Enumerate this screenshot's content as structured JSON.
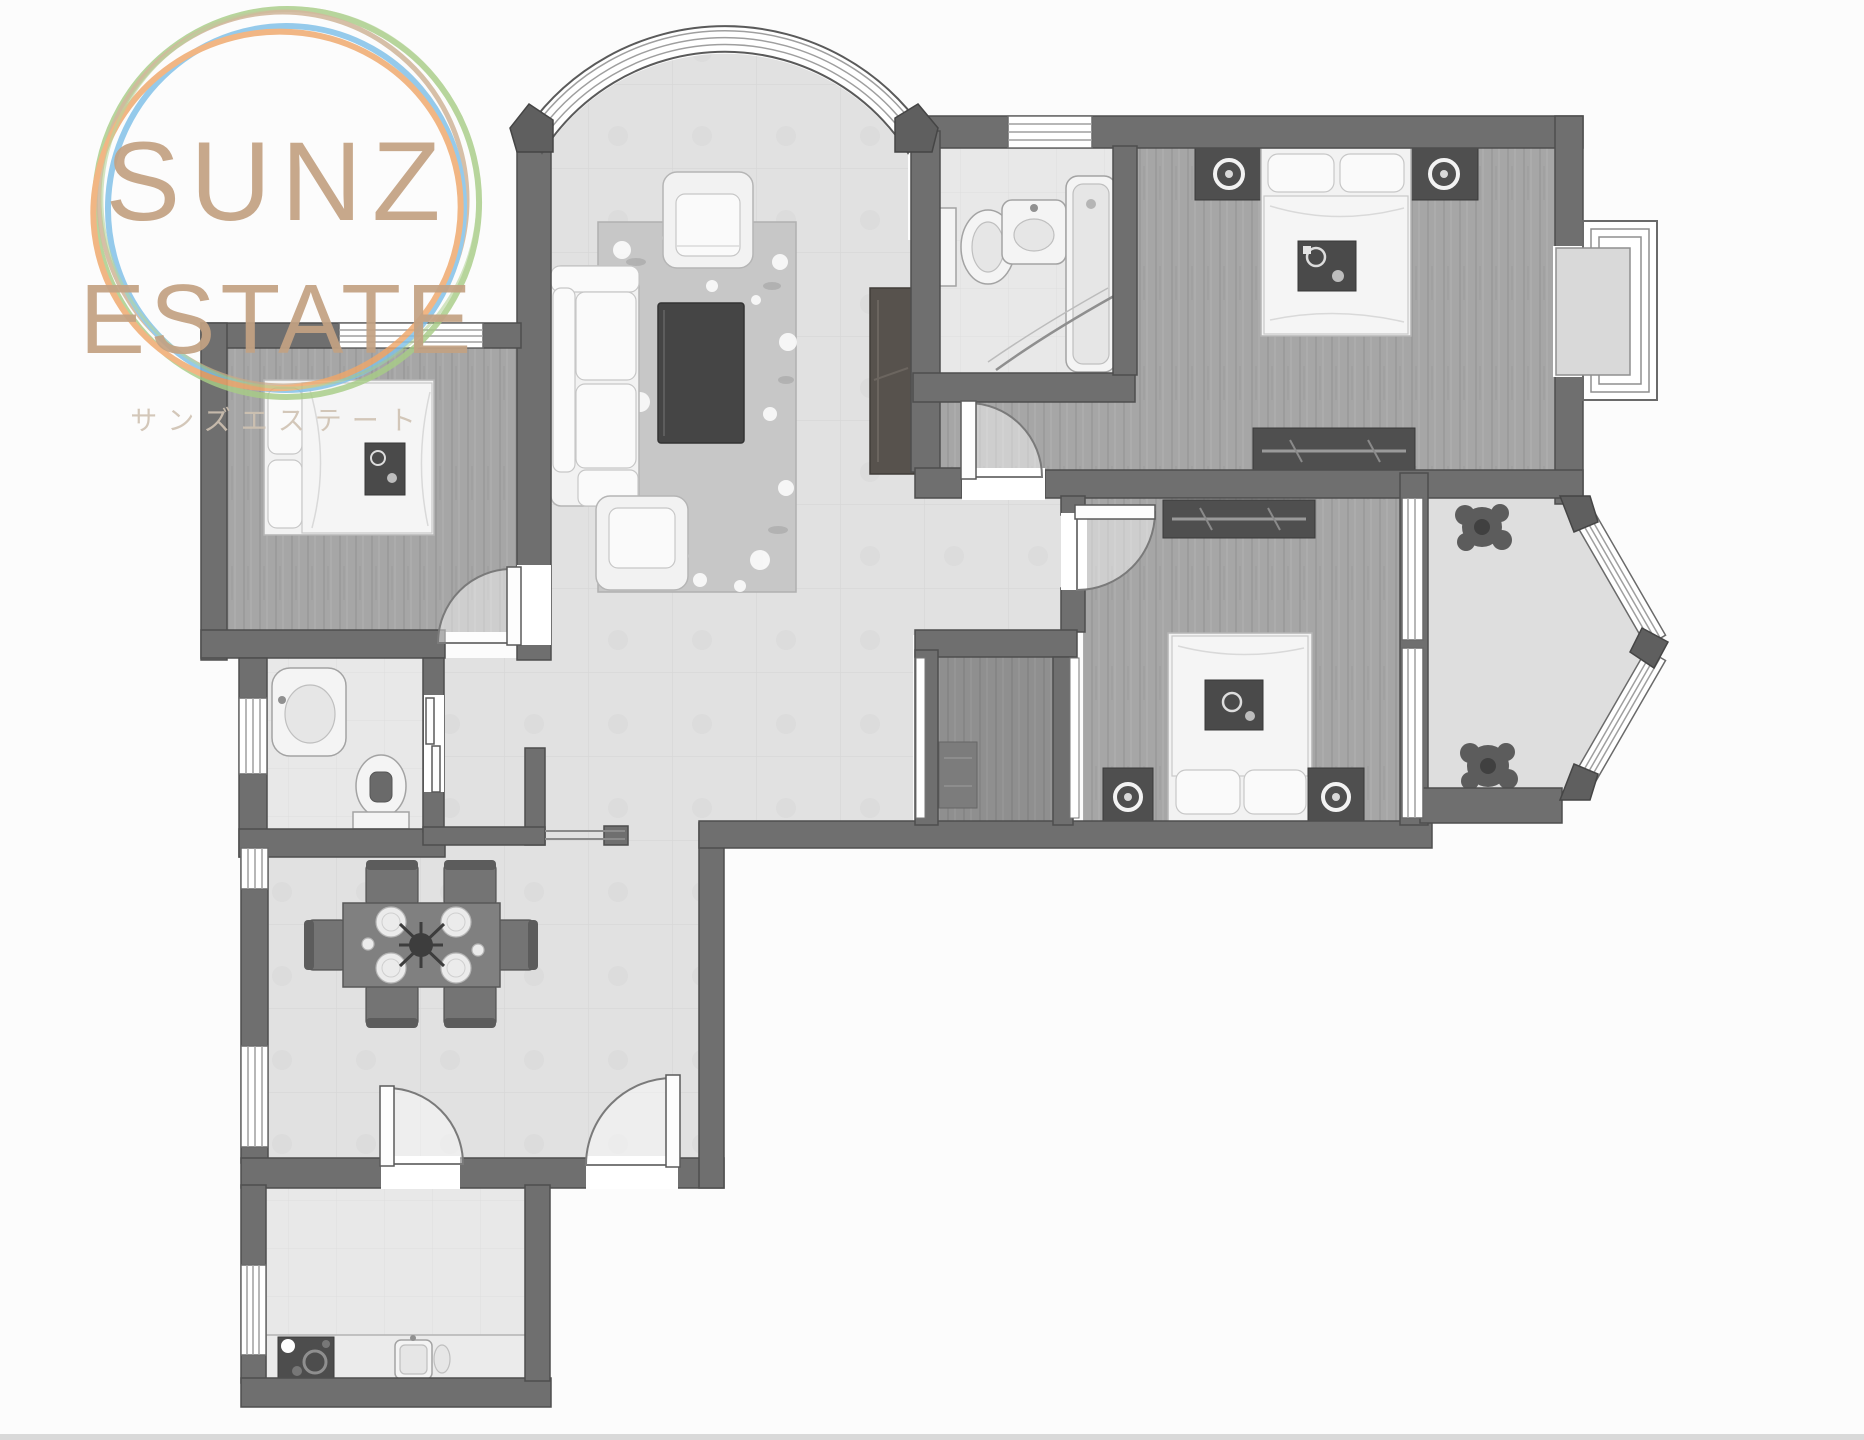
{
  "logo": {
    "line1": "SUNZ",
    "line2": "ESTATE",
    "subtitle": "サンズエステート"
  },
  "palette": {
    "logo_text": "#c3a283",
    "logo_subtitle": "#cfc2b2",
    "ring_green": "#a8cd87",
    "ring_tan": "#c9aa8a",
    "ring_blue": "#7fc0e8",
    "ring_orange": "#efa76a",
    "wall": "#6f6f6f",
    "wall_outline": "#4e4e4e",
    "tile_floor": "#e0e0e0",
    "bath_floor": "#e8e8e8",
    "wood_floor": "#a6a6a6",
    "wood_floor_dark": "#8f8f8f",
    "rug": "#c7c7c7",
    "dark_furniture": "#4f4f4f",
    "window_white": "#ffffff",
    "footer_bar": "#cfcfcf"
  }
}
